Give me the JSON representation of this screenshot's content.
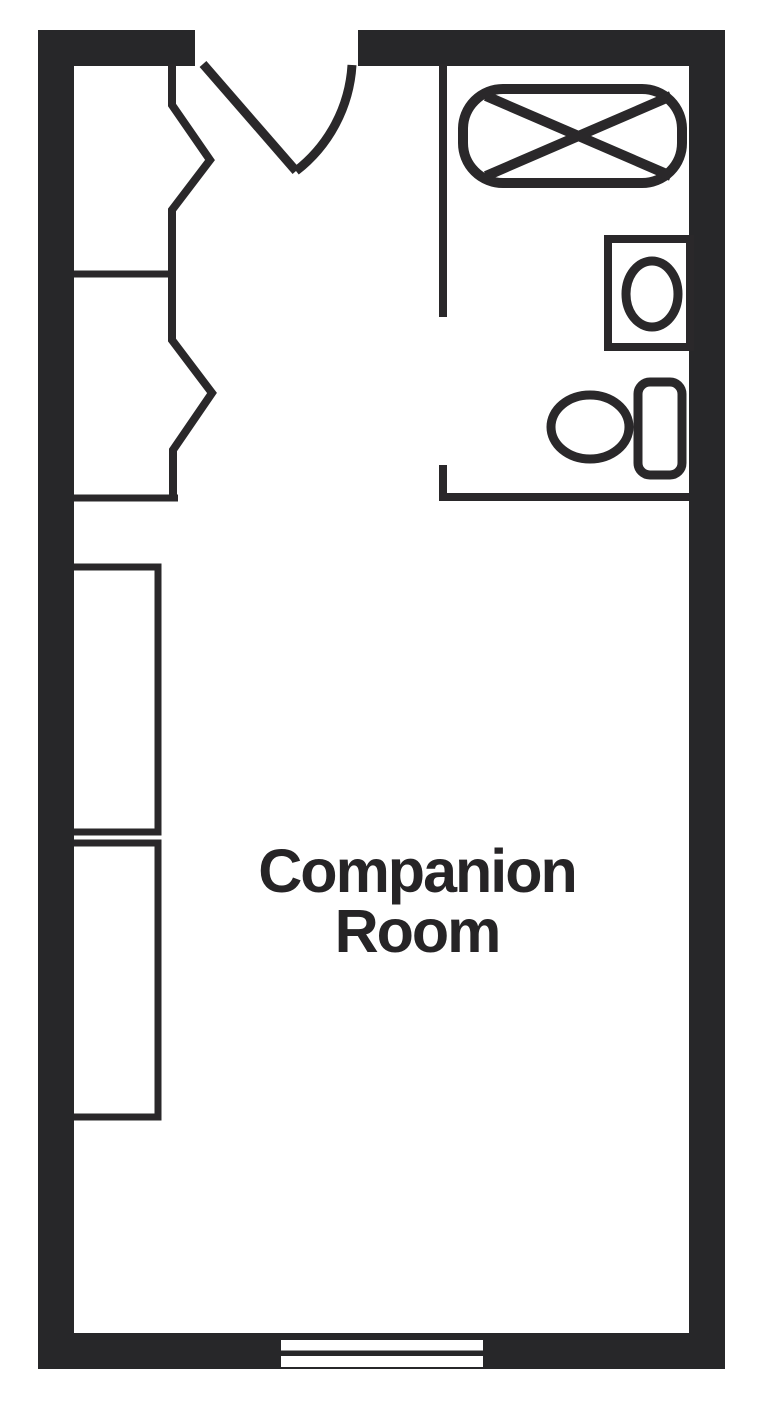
{
  "room": {
    "name_line1": "Companion",
    "name_line2": "Room",
    "full_name": "Companion Room"
  },
  "colors": {
    "wall": "#272729",
    "line": "#2a282a",
    "text": "#262426",
    "background": "#ffffff"
  },
  "fixtures": {
    "entry_door": "door-swing-icon",
    "closet_door_upper": "bifold-door-icon",
    "closet_door_lower": "bifold-door-icon",
    "closet_shelf_upper": "closet-divider-line",
    "closet_shelf_lower": "closet-divider-line",
    "bathroom_partition": "interior-wall",
    "bathtub": "bathtub-icon",
    "sink": "sink-icon",
    "toilet": "toilet-icon",
    "wardrobe_upper": "wardrobe-icon",
    "wardrobe_lower": "wardrobe-icon",
    "window": "window-icon"
  }
}
